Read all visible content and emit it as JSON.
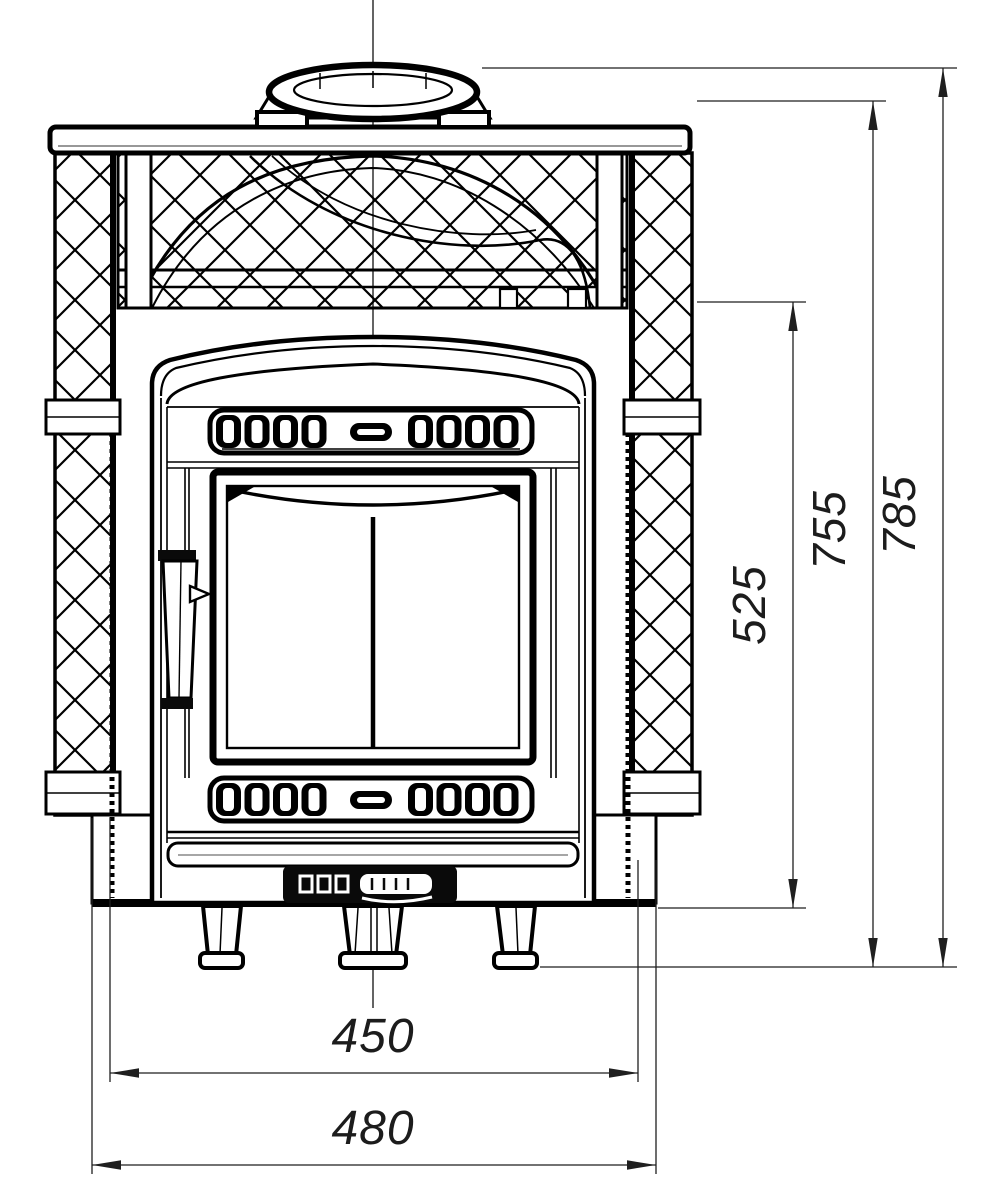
{
  "page": {
    "background": "#ffffff"
  },
  "drawing": {
    "kind": "technical front view of a sauna stove with stone-mesh casing",
    "line_color": "#000000",
    "dim_color": "#1f1f1f",
    "dims": {
      "base_width_inner": "450",
      "base_width_outer": "480",
      "firebox_height": "525",
      "body_height": "755",
      "total_height": "785"
    }
  }
}
